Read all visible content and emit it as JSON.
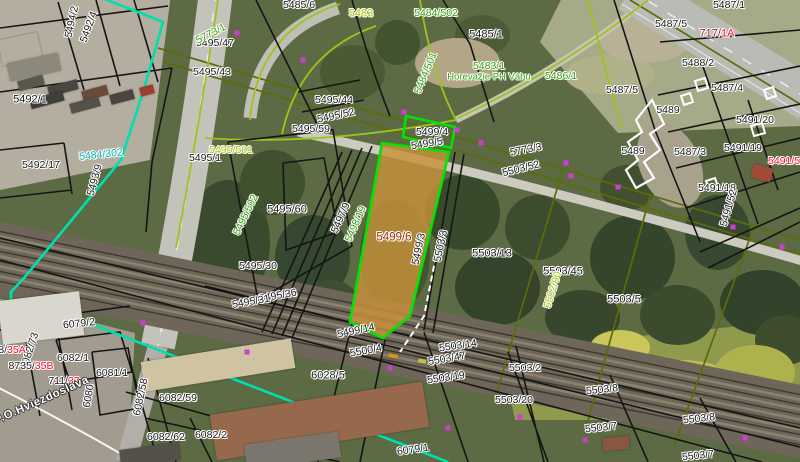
{
  "map": {
    "colors": {
      "black": "#191919",
      "green": "#35a40e",
      "lime": "#a9c804",
      "cyan": "#00b4ad",
      "red": "#fb0a25",
      "brick": "#973000",
      "darkred": "#8c1f28",
      "white": "#ffffff",
      "highlight_border": "#00e400",
      "highlight_fill": "#c8913a",
      "cyan_line": "#00dfae",
      "magenta_marker": "#d23bd2",
      "olive_line": "#5d6c08",
      "bright_green_line": "#9cc41c",
      "parcel_line": "#151515"
    },
    "highlighted_parcel": "5499/6",
    "labels": [
      {
        "text": "5494/2",
        "x": 72,
        "y": 22,
        "c": "black",
        "r": -78
      },
      {
        "text": "5492/4",
        "x": 89,
        "y": 27,
        "c": "black",
        "r": -70
      },
      {
        "text": "5492/1",
        "x": 30,
        "y": 100,
        "c": "black",
        "r": 0,
        "s": 11
      },
      {
        "text": "5492/17",
        "x": 41,
        "y": 165,
        "c": "black",
        "r": 0
      },
      {
        "text": "5484/302",
        "x": 101,
        "y": 155,
        "c": "cyan",
        "r": -6
      },
      {
        "text": "5493/9",
        "x": 95,
        "y": 180,
        "c": "black",
        "r": -75
      },
      {
        "text": "5495/47",
        "x": 215,
        "y": 43,
        "c": "black",
        "r": 0
      },
      {
        "text": "5495/43",
        "x": 212,
        "y": 72,
        "c": "black",
        "r": 0
      },
      {
        "text": "5495/1",
        "x": 205,
        "y": 158,
        "c": "black",
        "r": 0
      },
      {
        "text": "5495/501",
        "x": 231,
        "y": 150,
        "c": "lime",
        "r": 0
      },
      {
        "text": "5495/502",
        "x": 246,
        "y": 215,
        "c": "green",
        "r": -64
      },
      {
        "text": "5495/60",
        "x": 287,
        "y": 210,
        "c": "black",
        "r": 0,
        "s": 11
      },
      {
        "text": "5495/30",
        "x": 258,
        "y": 266,
        "c": "black",
        "r": 0
      },
      {
        "text": "5495/36",
        "x": 278,
        "y": 296,
        "c": "black",
        "r": -10
      },
      {
        "text": "5495/31",
        "x": 251,
        "y": 302,
        "c": "black",
        "r": -10
      },
      {
        "text": "5495/59",
        "x": 311,
        "y": 129,
        "c": "black",
        "r": 0
      },
      {
        "text": "5495/44",
        "x": 334,
        "y": 100,
        "c": "black",
        "r": 0
      },
      {
        "text": "5495/52",
        "x": 336,
        "y": 116,
        "c": "black",
        "r": -12
      },
      {
        "text": "5485/6",
        "x": 299,
        "y": 5,
        "c": "black",
        "r": 0
      },
      {
        "text": "5483",
        "x": 361,
        "y": 14,
        "c": "lime",
        "r": 0,
        "s": 11
      },
      {
        "text": "5484/502",
        "x": 436,
        "y": 13,
        "c": "green",
        "r": 0
      },
      {
        "text": "5484/501",
        "x": 426,
        "y": 73,
        "c": "green",
        "r": -68
      },
      {
        "text": "5485/1",
        "x": 486,
        "y": 35,
        "c": "black",
        "r": 0,
        "s": 11
      },
      {
        "text": "5483/1",
        "x": 489,
        "y": 66,
        "c": "green",
        "r": 0
      },
      {
        "text": "Horevažie PH Váhu",
        "x": 489,
        "y": 77,
        "c": "green",
        "r": 0,
        "s": 9.5
      },
      {
        "text": "5486/1",
        "x": 561,
        "y": 76,
        "c": "green",
        "r": 0
      },
      {
        "text": "5773/1",
        "x": 211,
        "y": 34,
        "c": "green",
        "r": -27
      },
      {
        "text": "5773/3",
        "x": 526,
        "y": 150,
        "c": "black",
        "r": -11
      },
      {
        "text": "5503/52",
        "x": 521,
        "y": 169,
        "c": "black",
        "r": -14
      },
      {
        "text": "5487/1",
        "x": 729,
        "y": 5,
        "c": "black",
        "r": 0
      },
      {
        "text": "5487/5",
        "x": 671,
        "y": 24,
        "c": "black",
        "r": 0
      },
      {
        "parts": [
          {
            "text": "717/",
            "c": "darkred"
          },
          {
            "text": "1A",
            "c": "red"
          }
        ],
        "x": 717,
        "y": 34,
        "r": 0,
        "s": 11
      },
      {
        "text": "5488/2",
        "x": 698,
        "y": 63,
        "c": "black",
        "r": 0
      },
      {
        "text": "5487/4",
        "x": 727,
        "y": 88,
        "c": "black",
        "r": 0
      },
      {
        "text": "5487/5",
        "x": 622,
        "y": 90,
        "c": "black",
        "r": 0
      },
      {
        "text": "5489",
        "x": 668,
        "y": 110,
        "c": "black",
        "r": 0
      },
      {
        "text": "5489",
        "x": 633,
        "y": 151,
        "c": "black",
        "r": 0
      },
      {
        "text": "5487/3",
        "x": 690,
        "y": 152,
        "c": "black",
        "r": 0
      },
      {
        "text": "5491/20",
        "x": 755,
        "y": 120,
        "c": "black",
        "r": 0
      },
      {
        "text": "5491/19",
        "x": 743,
        "y": 148,
        "c": "black",
        "r": 0
      },
      {
        "text": "5491/57",
        "x": 787,
        "y": 161,
        "c": "red",
        "r": 0
      },
      {
        "text": "5491/18",
        "x": 717,
        "y": 188,
        "c": "black",
        "r": 0
      },
      {
        "text": "5491/52",
        "x": 729,
        "y": 208,
        "c": "black",
        "r": -74
      },
      {
        "text": "5497/9",
        "x": 341,
        "y": 218,
        "c": "black",
        "r": -66
      },
      {
        "text": "5498/19",
        "x": 356,
        "y": 224,
        "c": "green",
        "r": -66
      },
      {
        "text": "5499/4",
        "x": 432,
        "y": 132,
        "c": "black",
        "r": 0
      },
      {
        "text": "5499/5",
        "x": 427,
        "y": 144,
        "c": "black",
        "r": -9
      },
      {
        "text": "5499/6",
        "x": 394,
        "y": 238,
        "c": "brick",
        "r": 0,
        "s": 11.5
      },
      {
        "text": "5499/3",
        "x": 419,
        "y": 249,
        "c": "black",
        "r": -78
      },
      {
        "text": "5503/3",
        "x": 441,
        "y": 246,
        "c": "black",
        "r": -78
      },
      {
        "text": "5503/13",
        "x": 492,
        "y": 254,
        "c": "black",
        "r": 0,
        "s": 11
      },
      {
        "text": "5503/45",
        "x": 563,
        "y": 272,
        "c": "black",
        "r": 0,
        "s": 11
      },
      {
        "text": "5502/90",
        "x": 553,
        "y": 290,
        "c": "lime",
        "r": -73
      },
      {
        "text": "5503/5",
        "x": 624,
        "y": 300,
        "c": "black",
        "r": 0,
        "s": 11
      },
      {
        "text": "5499/14",
        "x": 356,
        "y": 331,
        "c": "black",
        "r": -12
      },
      {
        "text": "5500/4",
        "x": 366,
        "y": 351,
        "c": "black",
        "r": -10
      },
      {
        "text": "5503/14",
        "x": 458,
        "y": 346,
        "c": "black",
        "r": -8
      },
      {
        "text": "5503/47",
        "x": 447,
        "y": 359,
        "c": "black",
        "r": -10
      },
      {
        "text": "5503/19",
        "x": 446,
        "y": 378,
        "c": "black",
        "r": -8
      },
      {
        "text": "6028/5",
        "x": 328,
        "y": 376,
        "c": "black",
        "r": 0,
        "s": 11
      },
      {
        "text": "5503/2",
        "x": 525,
        "y": 368,
        "c": "black",
        "r": 0
      },
      {
        "text": "5503/20",
        "x": 514,
        "y": 400,
        "c": "black",
        "r": 0
      },
      {
        "text": "5503/8",
        "x": 602,
        "y": 390,
        "c": "black",
        "r": -6
      },
      {
        "text": "5503/8",
        "x": 699,
        "y": 419,
        "c": "black",
        "r": -6
      },
      {
        "text": "5503/7",
        "x": 601,
        "y": 428,
        "c": "black",
        "r": -6
      },
      {
        "text": "5503/7",
        "x": 698,
        "y": 456,
        "c": "black",
        "r": -6
      },
      {
        "text": "6079/1",
        "x": 413,
        "y": 450,
        "c": "black",
        "r": -8
      },
      {
        "text": "6079/2",
        "x": 79,
        "y": 324,
        "c": "black",
        "r": -6
      },
      {
        "text": "6082/1",
        "x": 73,
        "y": 358,
        "c": "black",
        "r": 0
      },
      {
        "text": "6081/1",
        "x": 112,
        "y": 373,
        "c": "black",
        "r": 0
      },
      {
        "text": "6082/73",
        "x": 30,
        "y": 351,
        "c": "black",
        "r": -72
      },
      {
        "parts": [
          {
            "text": "8/",
            "c": "black"
          },
          {
            "text": "35A",
            "c": "red"
          }
        ],
        "x": 12,
        "y": 350,
        "r": 0
      },
      {
        "parts": [
          {
            "text": "8735/",
            "c": "black"
          },
          {
            "text": "35B",
            "c": "red"
          }
        ],
        "x": 31,
        "y": 366,
        "r": 0
      },
      {
        "parts": [
          {
            "text": "711/",
            "c": "black"
          },
          {
            "text": "37",
            "c": "red"
          }
        ],
        "x": 64,
        "y": 381,
        "r": 0
      },
      {
        "text": "P.O.Hviezdoslava",
        "x": 42,
        "y": 401,
        "c": "white",
        "r": -24,
        "s": 11.5,
        "white": true
      },
      {
        "text": "6080",
        "x": 89,
        "y": 396,
        "c": "black",
        "r": -80
      },
      {
        "text": "6082/58",
        "x": 141,
        "y": 397,
        "c": "black",
        "r": -78
      },
      {
        "text": "6082/59",
        "x": 178,
        "y": 398,
        "c": "black",
        "r": 0
      },
      {
        "text": "6082/62",
        "x": 166,
        "y": 437,
        "c": "black",
        "r": 0
      },
      {
        "text": "6082/2",
        "x": 211,
        "y": 435,
        "c": "black",
        "r": 0
      }
    ],
    "markers": [
      [
        237,
        33
      ],
      [
        303,
        60
      ],
      [
        404,
        112
      ],
      [
        457,
        130
      ],
      [
        481,
        143
      ],
      [
        566,
        163
      ],
      [
        571,
        176
      ],
      [
        618,
        187
      ],
      [
        733,
        227
      ],
      [
        782,
        247
      ],
      [
        143,
        323
      ],
      [
        247,
        352
      ],
      [
        390,
        368
      ],
      [
        448,
        428
      ],
      [
        520,
        417
      ],
      [
        585,
        440
      ],
      [
        745,
        438
      ]
    ]
  }
}
